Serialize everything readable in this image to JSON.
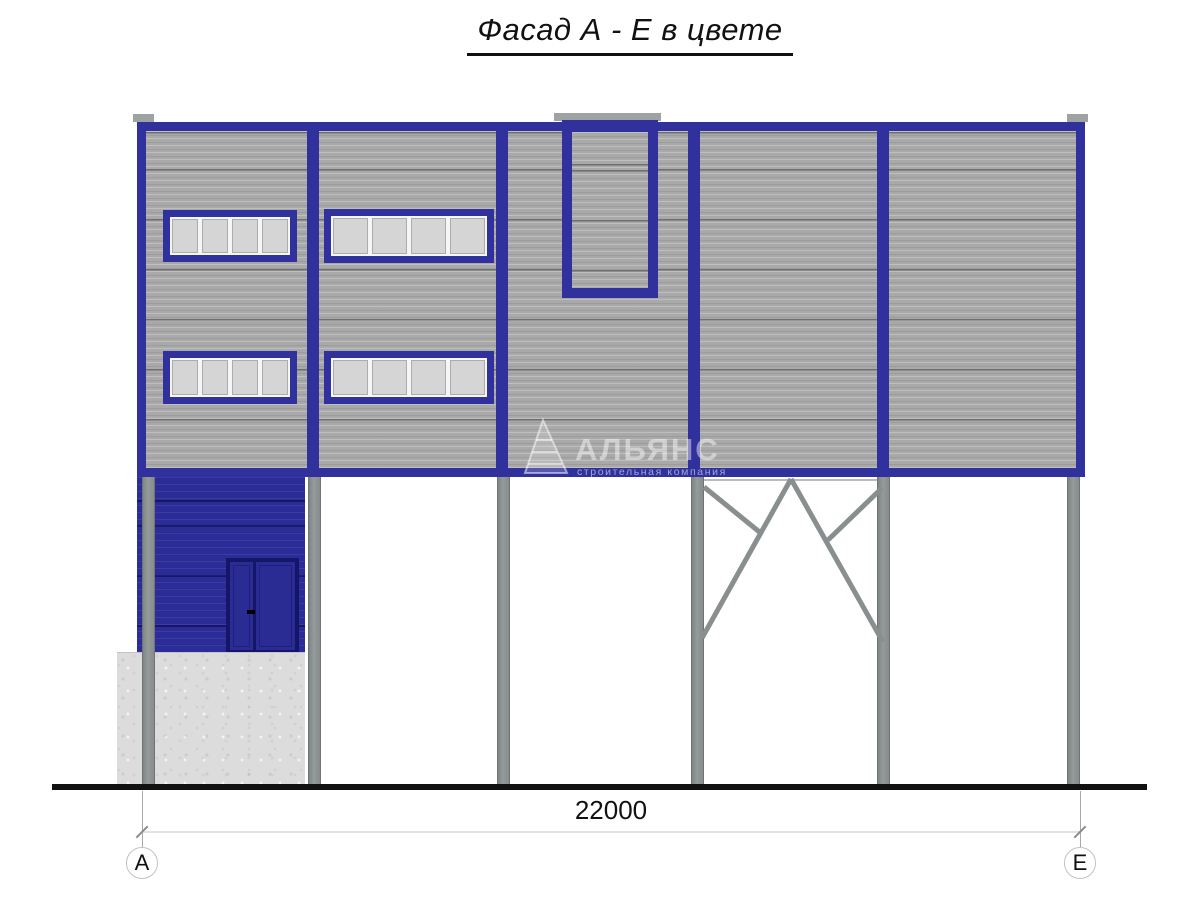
{
  "title": "Фасад А - Е в цвете",
  "watermark": {
    "icon": "sail-logo-icon",
    "name": "АЛЬЯНС",
    "subtitle": "строительная компания"
  },
  "dimension": {
    "label": "22000"
  },
  "grid_markers": {
    "left": "А",
    "right": "Е"
  },
  "structure": {
    "windows": {
      "count": 4,
      "panes_each": 4
    },
    "columns_count": 6,
    "door": "double-leaf entrance door",
    "braced_bay": "diagonal roof bracing between columns 4 and 5",
    "notch": "parapet recess at roof line",
    "plinth": "concrete block under annex"
  },
  "colors": {
    "frame_blue": "#31319d",
    "wall_panel_gray": "#a9a9a9",
    "annex_blue": "#2c2c99",
    "door_blue": "#2b2b94",
    "window_pane_gray": "#d5d5d5",
    "steel_column_gray": "#8c9191",
    "concrete_plinth_gray": "#dcdcdc",
    "ground_line_black": "#0d0d0d"
  }
}
